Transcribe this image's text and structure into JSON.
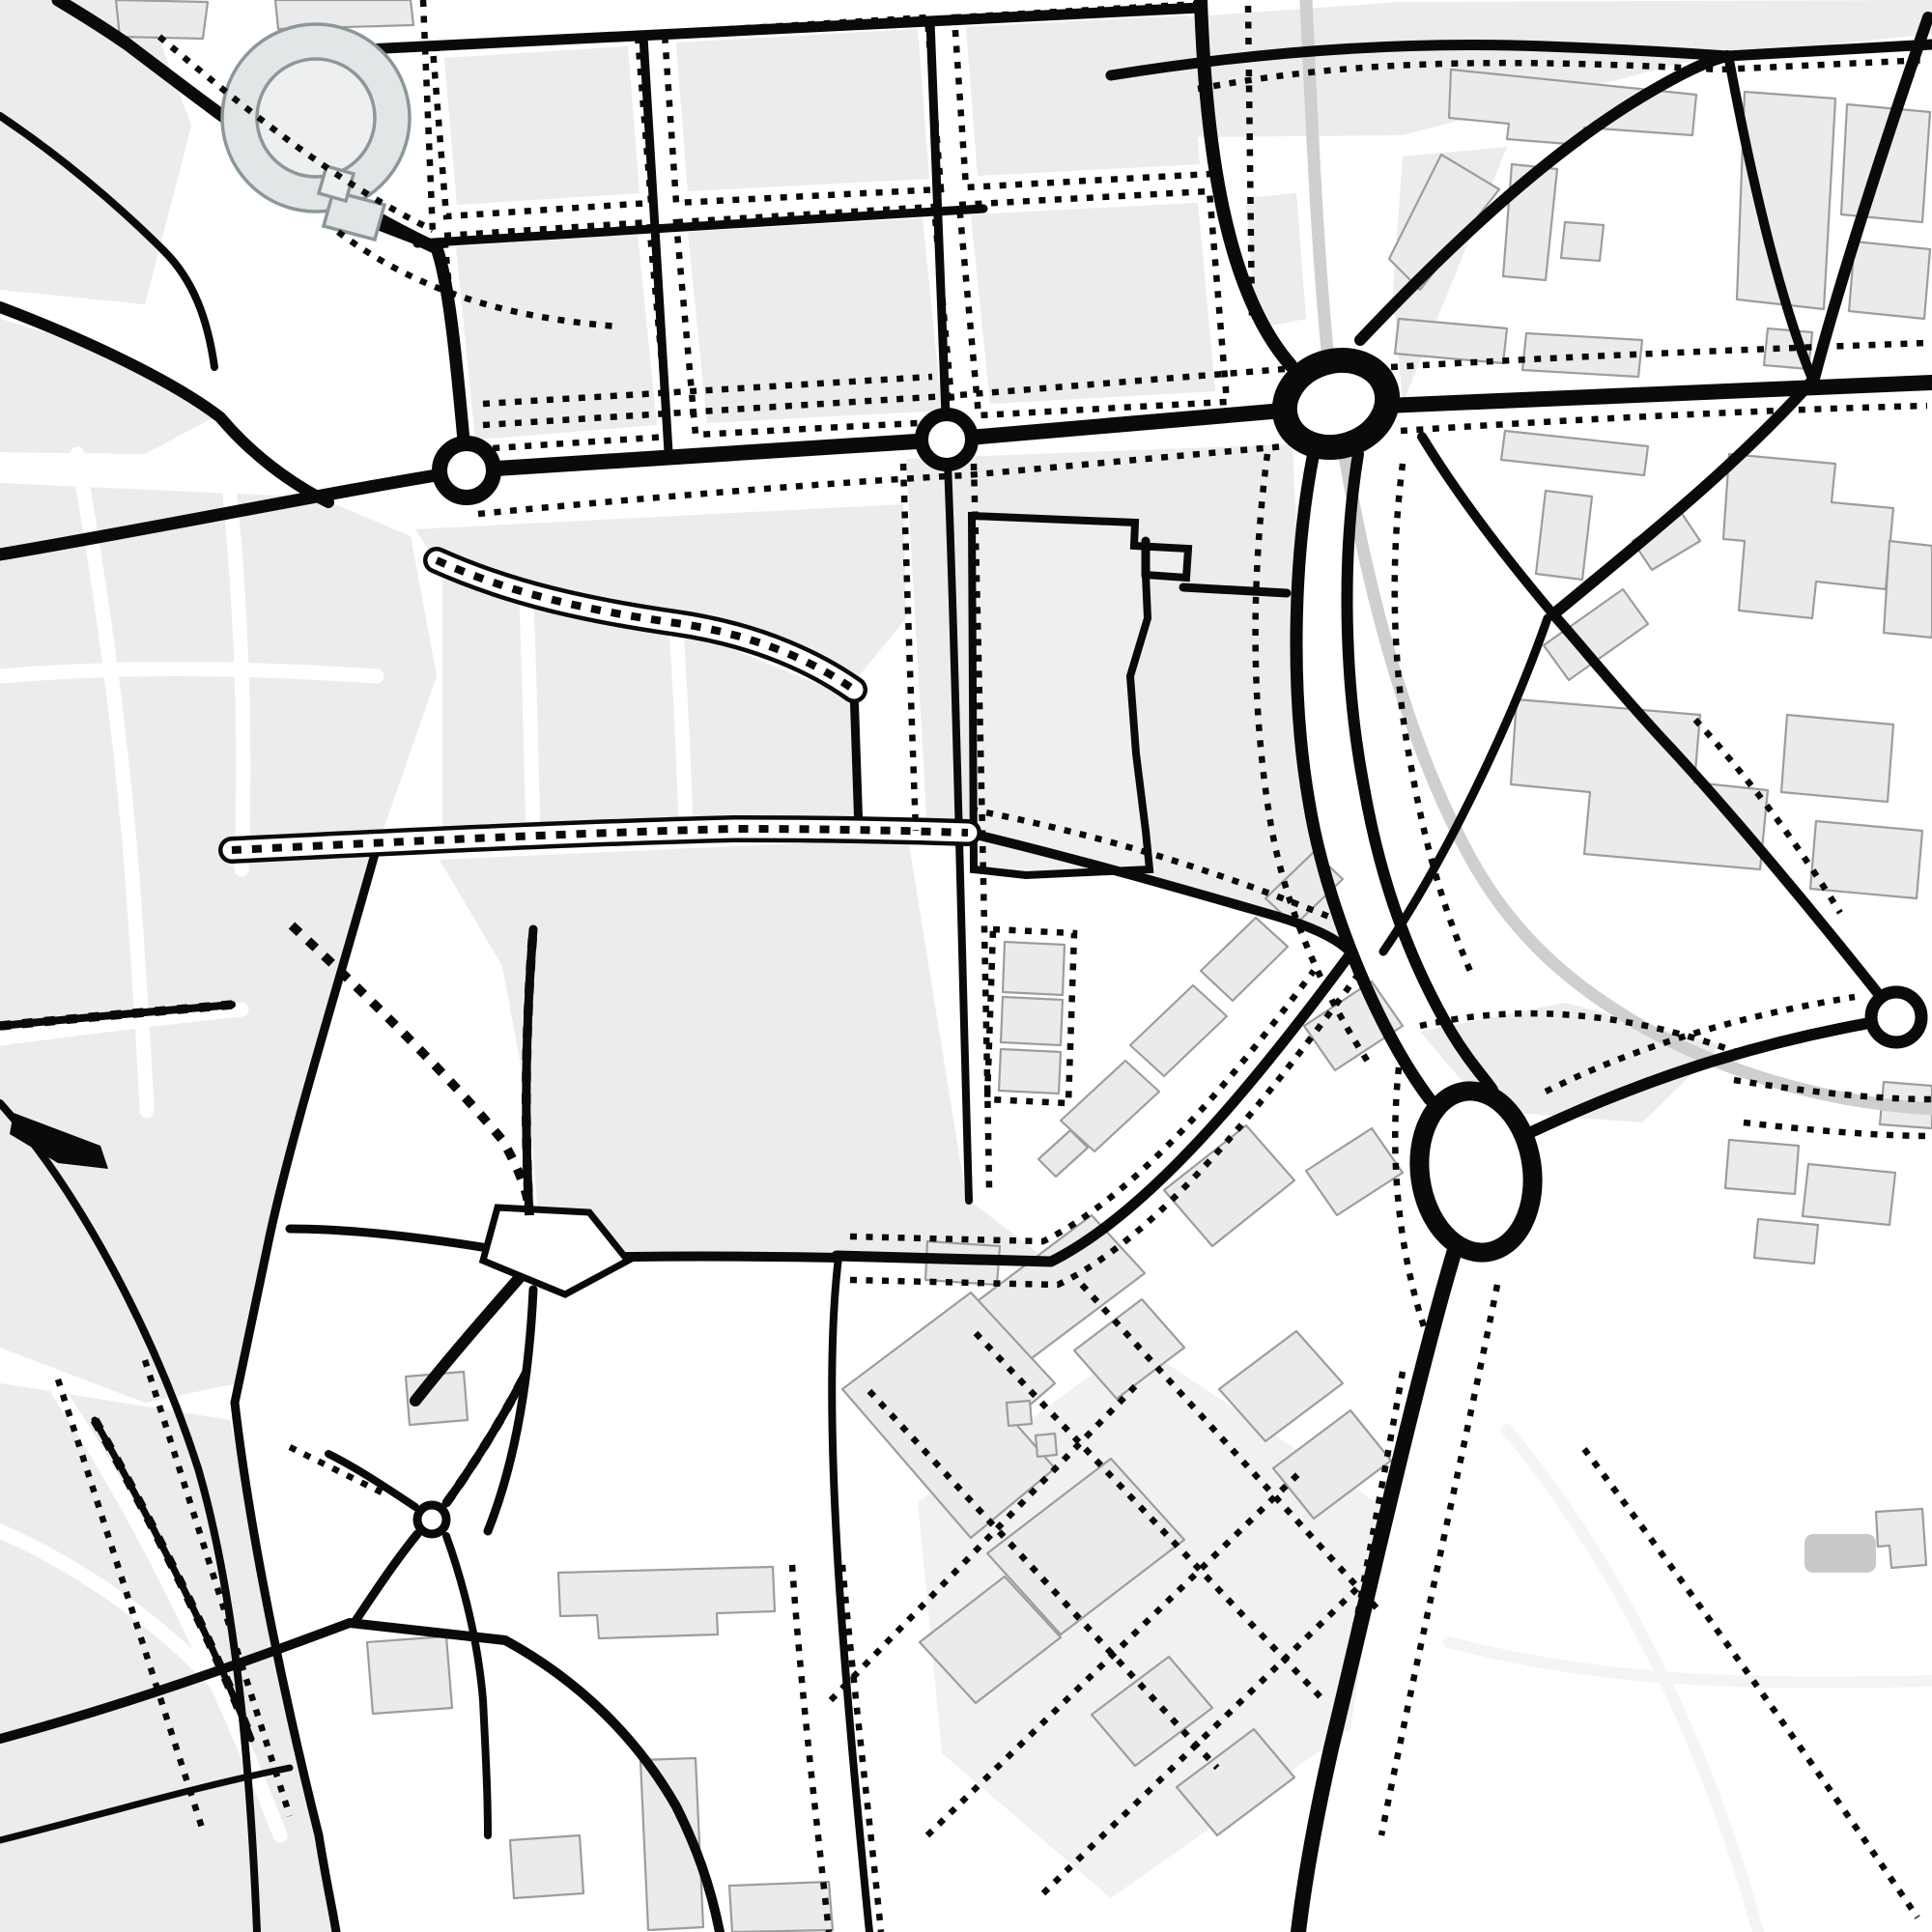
{
  "app": {
    "title": "monochrome-city-street-map"
  },
  "theme": {
    "bg": "#ffffff",
    "road": "#0a0a0a",
    "building-fill": "#ebebeb",
    "building-stroke": "#9d9d9d",
    "zone": "#ececec",
    "parcel": "#b4b4b4",
    "rail": "#cfcfcf",
    "faint": "#f4f4f4",
    "stadium-fill": "#e3e6e7",
    "stadium-inner": "#eef0f0",
    "stadium-stroke": "#8c969b",
    "dark-building": "#c9c9c9",
    "plaza": "#f1f1f1"
  },
  "map": {
    "kind": "street-map-monochrome",
    "features": [
      {
        "name": "stadium-arena-ring"
      },
      {
        "name": "roundabout-west"
      },
      {
        "name": "roundabout-center"
      },
      {
        "name": "roundabout-main-junction"
      },
      {
        "name": "roundabout-large-ellipse"
      },
      {
        "name": "roundabout-east"
      },
      {
        "name": "mini-roundabout-southwest"
      },
      {
        "name": "tram-rail-line"
      },
      {
        "name": "pedestrian-corridor-walled"
      },
      {
        "name": "pedestrian-street-dotted"
      },
      {
        "name": "old-town-parcel-zones"
      },
      {
        "name": "city-block-grid-north"
      },
      {
        "name": "campus-plaza-south"
      },
      {
        "name": "footpath-network-dashed"
      }
    ]
  }
}
